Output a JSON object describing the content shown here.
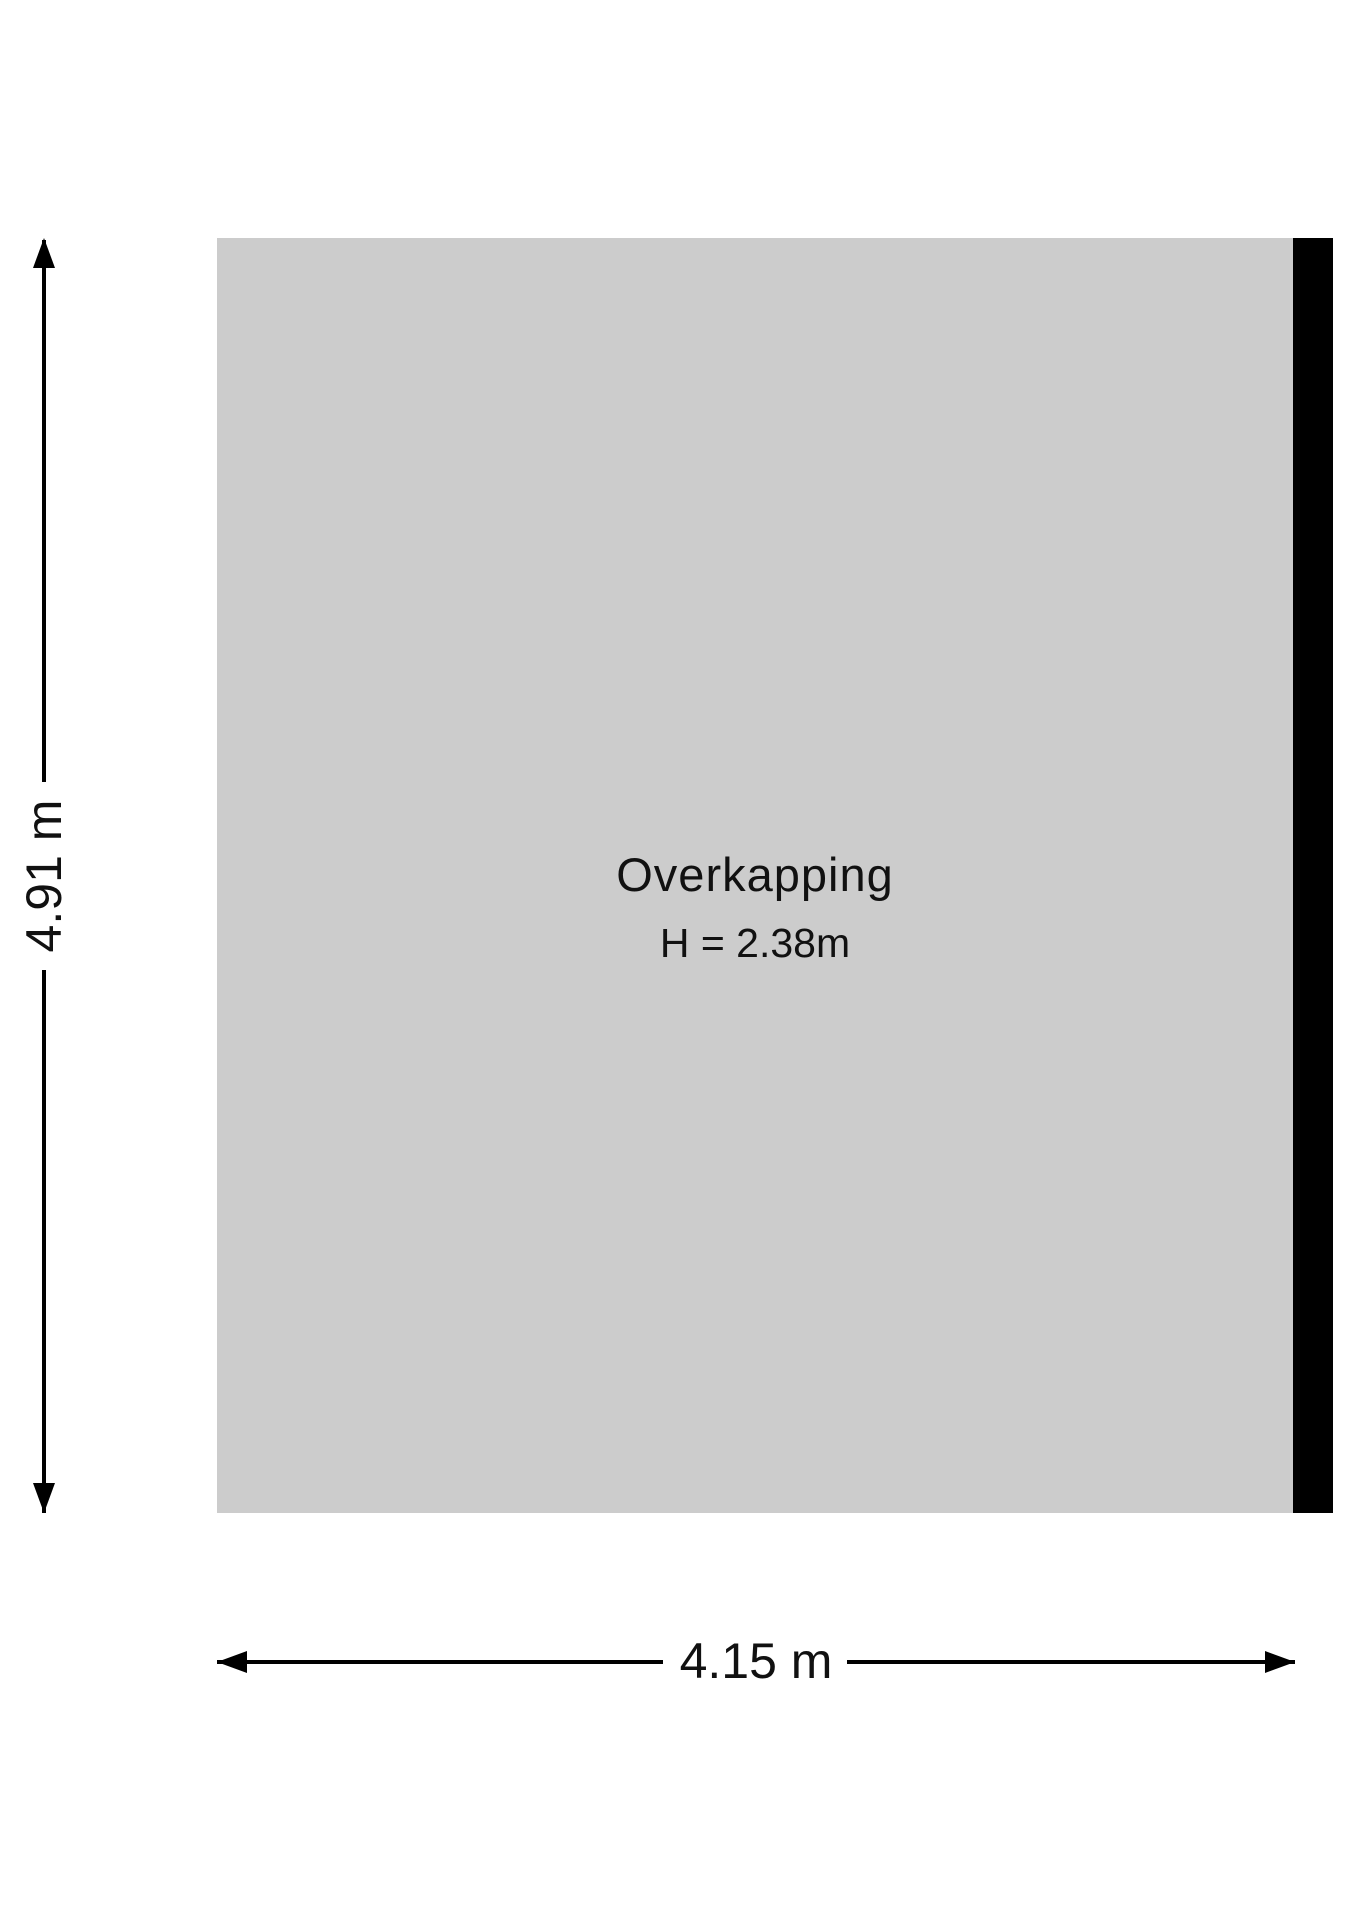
{
  "floorplan": {
    "room": {
      "name": "Overkapping",
      "ceiling_height_label": "H = 2.38m",
      "fill_color": "#cccccc",
      "wall_color": "#000000"
    },
    "dimensions": {
      "vertical": {
        "label": "4.91 m"
      },
      "horizontal": {
        "label": "4.15 m"
      }
    }
  }
}
